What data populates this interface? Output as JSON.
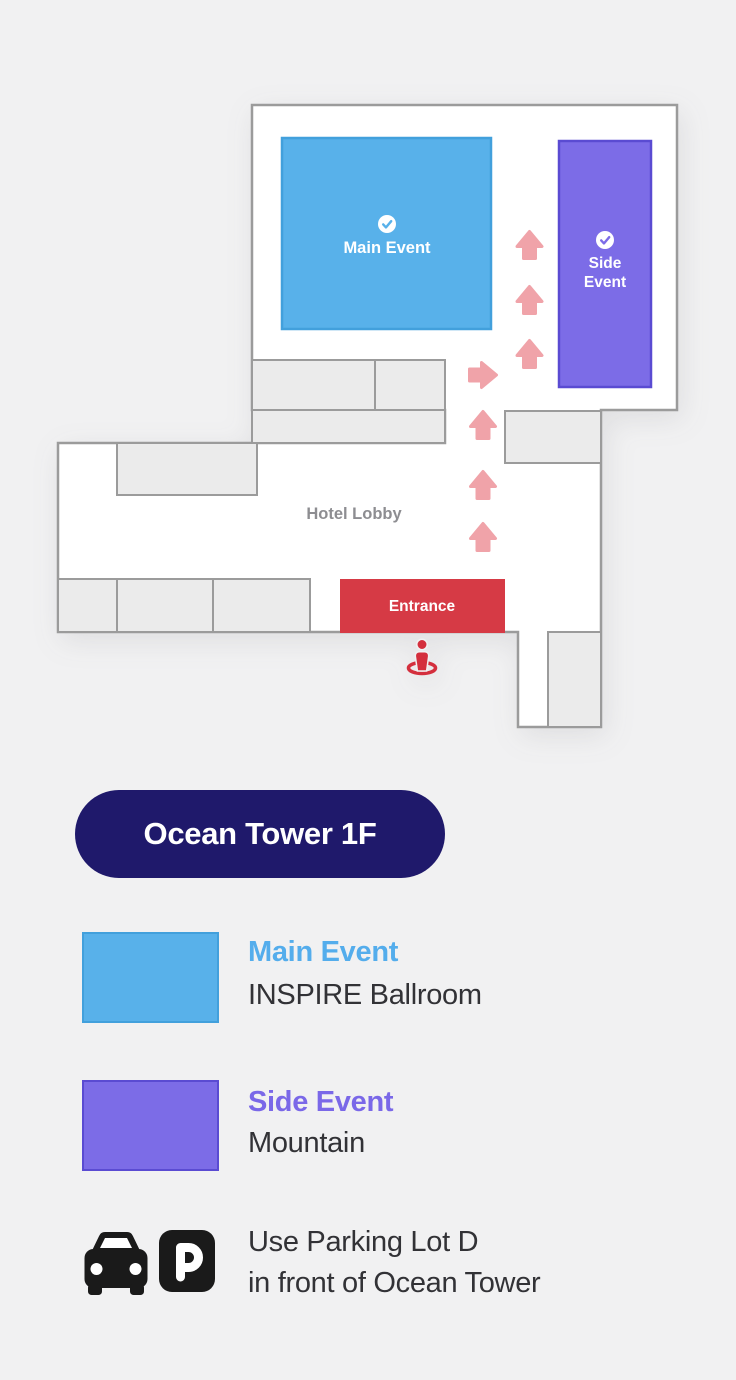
{
  "map": {
    "main_event_label": "Main Event",
    "side_event_line1": "Side",
    "side_event_line2": "Event",
    "hotel_lobby_label": "Hotel Lobby",
    "entrance_label": "Entrance"
  },
  "badge": {
    "label": "Ocean Tower 1F"
  },
  "legend": {
    "items": [
      {
        "title": "Main Event",
        "subtitle": "INSPIRE Ballroom",
        "color": "#58b1ea"
      },
      {
        "title": "Side Event",
        "subtitle": "Mountain",
        "color": "#7c6ce7"
      }
    ]
  },
  "parking": {
    "line1": "Use Parking Lot D",
    "line2": "in front of Ocean Tower",
    "sign_glyph": "P"
  },
  "colors": {
    "background": "#f1f1f2",
    "wall": "#9b9b9b",
    "room_gray": "#ebebeb",
    "main_event_blue": "#58b1ea",
    "side_event_purple": "#7c6ce7",
    "entrance_red": "#d63a45",
    "location_pin_red": "#d42f3d",
    "route_arrow_pink": "#f0a3a9",
    "badge_navy": "#1f196b"
  }
}
